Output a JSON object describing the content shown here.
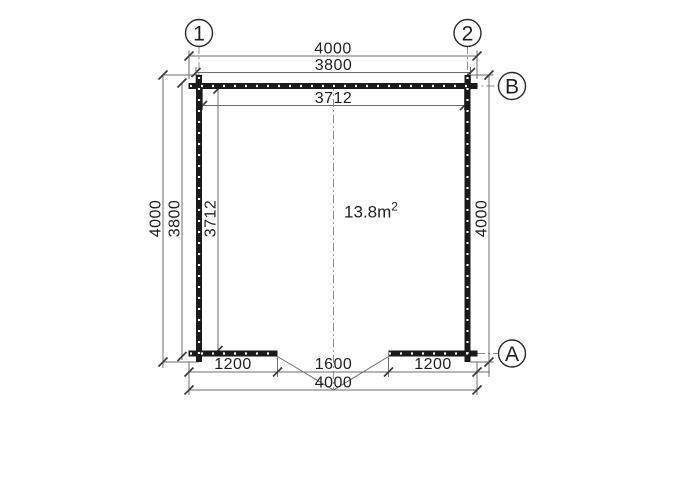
{
  "colors": {
    "background": "#ffffff",
    "wall": "#1a1a1a",
    "line": "#6e6e6e",
    "tick": "#3c3c3c",
    "text": "#1f1f1f",
    "centerline": "#909090",
    "circle": "#2a2a2a"
  },
  "grid": {
    "col_1": "1",
    "col_2": "2",
    "row_b": "B",
    "row_a": "A"
  },
  "dimensions": {
    "top": {
      "overall": "4000",
      "shell": "3800",
      "interior": "3712"
    },
    "left": {
      "overall": "4000",
      "shell": "3800",
      "interior": "3712"
    },
    "right": {
      "overall": "4000"
    },
    "bottom": {
      "left_segment": "1200",
      "opening": "1600",
      "right_segment": "1200",
      "overall": "4000"
    }
  },
  "area_label": {
    "value": "13.8m",
    "superscript": "2"
  }
}
